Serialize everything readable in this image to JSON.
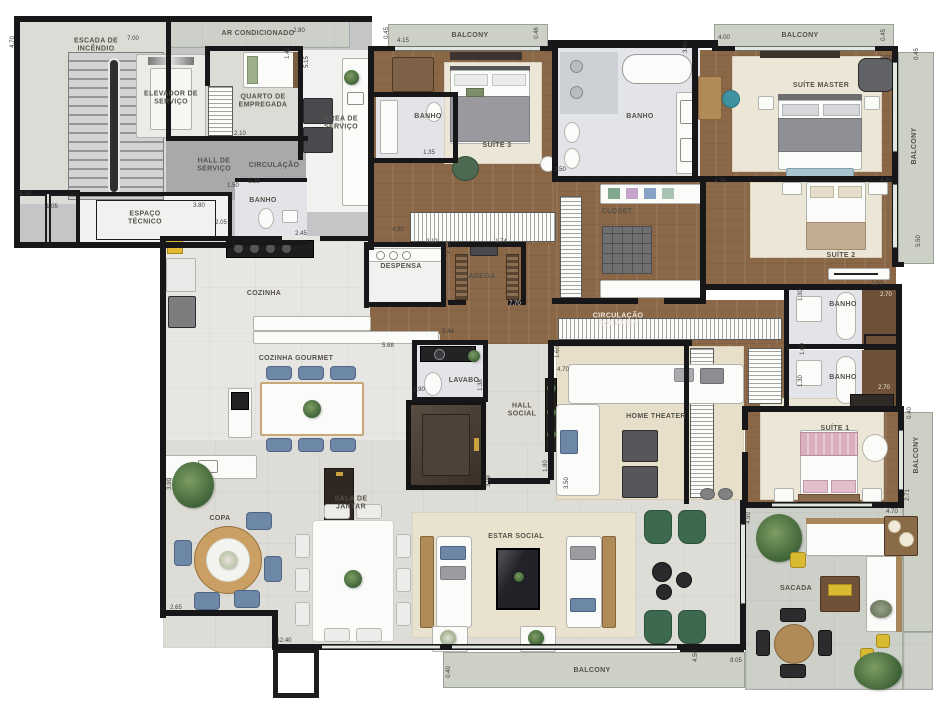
{
  "labels": {
    "escada": "ESCADA DE INCÊNDIO",
    "elevador_servico": "ELEVADOR DE SERVIÇO",
    "ar_condicionado": "AR CONDICIONADO",
    "quarto_empregada": "QUARTO DE EMPREGADA",
    "circulacao": "CIRCULAÇÃO",
    "hall_servico": "HALL DE SERVIÇO",
    "espaco_tecnico": "ESPAÇO TÉCNICO",
    "banho": "BANHO",
    "area_servico": "ÁREA DE SERVIÇO",
    "balcony": "BALCONY",
    "suite_3": "SUÍTE 3",
    "suite_master": "SUÍTE MASTER",
    "closet": "CLOSET",
    "suite_2": "SUÍTE 2",
    "despensa": "DESPENSA",
    "adega": "ADEGA",
    "cozinha": "COZINHA",
    "circulacao_rouparia": "CIRCULAÇÃO ROUPARIA",
    "cozinha_gourmet": "COZINHA GOURMET",
    "lavabo": "LAVABO",
    "hall_social": "HALL SOCIAL",
    "home_theater": "HOME THEATER",
    "sala_de_jantar": "SALA DE JANTAR",
    "copa": "COPA",
    "estar_social": "ESTAR SOCIAL",
    "suite_1": "SUÍTE 1",
    "sacada": "SACADA"
  },
  "dims": [
    "4.70",
    "2.80",
    "7.00",
    "1.42",
    "5.15",
    "2.10",
    "4.30",
    "1.05",
    "3.80",
    "1.50",
    "1.25",
    "2.05",
    "2.45",
    "0.45",
    "4.15",
    "0.46",
    "4.00",
    "0.45",
    "3.40",
    "5.50",
    "0.45",
    "1.35",
    "3.50",
    "4.75",
    "4.40",
    "4.30",
    "2.12",
    "2.10",
    "1.74",
    "7.70",
    "9.44",
    "5.68",
    "1.90",
    "1.38",
    "1.60",
    "4.70",
    "1.80",
    "3.50",
    "3.99",
    "2.50",
    "2.70",
    "1.30",
    "1.60",
    "2.70",
    "1.30",
    "0.40",
    "4.90",
    "4.70",
    "2.71",
    "2.65",
    "3.90",
    "12.40",
    "0.40",
    "4.50",
    "8.05",
    "5.50"
  ],
  "colors": {
    "wall": "#17171a",
    "wood_floor": "#8a6747",
    "balcony_floor": "#ccd0c7",
    "accent_yellow": "#d9ba32",
    "accent_green": "#3d6a4e",
    "accent_blue": "#6d87a6",
    "accent_pink": "#d9aebd"
  }
}
